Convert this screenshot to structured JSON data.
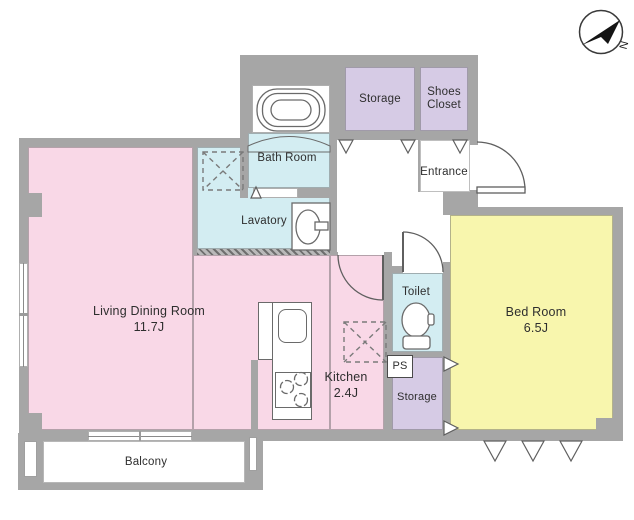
{
  "canvas": {
    "width": 634,
    "height": 520
  },
  "colors": {
    "wall": "#a6a6a6",
    "living_pink": "#f9d8e7",
    "bedroom_yellow": "#f8f6ad",
    "wet_cyan": "#d3edf2",
    "closet_lavender": "#d6cbe5",
    "floor_white": "#ffffff",
    "line_dark": "#5f5f5f"
  },
  "compass": {
    "label": "N"
  },
  "rooms": {
    "living": {
      "label": "Living Dining Room",
      "size": "11.7J"
    },
    "kitchen": {
      "label": "Kitchen",
      "size": "2.4J"
    },
    "bedroom": {
      "label": "Bed Room",
      "size": "6.5J"
    },
    "bathroom": {
      "label": "Bath Room"
    },
    "lavatory": {
      "label": "Lavatory"
    },
    "toilet": {
      "label": "Toilet"
    },
    "storage_top": {
      "label": "Storage"
    },
    "shoes_closet": {
      "label": "Shoes Closet"
    },
    "entrance": {
      "label": "Entrance"
    },
    "storage_bottom": {
      "label": "Storage"
    },
    "pipe_space": {
      "label": "PS"
    },
    "balcony": {
      "label": "Balcony"
    }
  }
}
